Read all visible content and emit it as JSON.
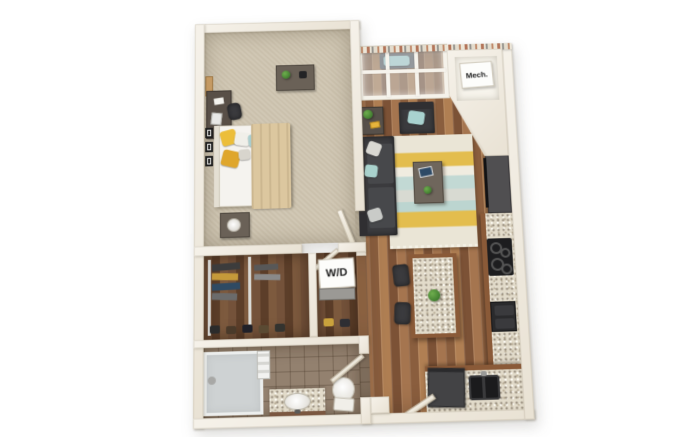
{
  "image": {
    "type": "3d-floor-plan",
    "description": "Top-down 3D dollhouse rendering of a one-bedroom, one-bathroom apartment floor plan on a white background"
  },
  "labels": {
    "mech": "Mech.",
    "wd": "W/D"
  },
  "palette": {
    "background": "#ffffff",
    "walls": "#f1ece3",
    "wall_shadow": "#d9d2c3",
    "bedroom_carpet": "#cfc5b1",
    "hardwood_floor": "#9c7049",
    "closet_wood": "#6b4a32",
    "bathroom_tile": "#93816f",
    "granite_counter": "#e2dbca",
    "cabinet_wood": "#8a5a38",
    "sofa_charcoal": "#3b3b3e",
    "accent_teal": "#accfcf",
    "accent_yellow": "#e6b93c",
    "rug_cream": "#eae5d6",
    "appliance_black": "#1d1d1f",
    "brick_trim": "#b3755a"
  },
  "regions": [
    {
      "id": "bedroom",
      "furniture": [
        "bed",
        "yellow-pillows",
        "teal-pillow",
        "throw-blanket",
        "nightstand",
        "table-lamp",
        "desk",
        "desk-chair",
        "laptop",
        "dresser",
        "potted-plant",
        "wall-art-frames",
        "pinboard",
        "door"
      ]
    },
    {
      "id": "living-room",
      "furniture": [
        "sectional-sofa",
        "throw-pillows",
        "armchair",
        "striped-area-rug",
        "coffee-table",
        "tablet",
        "small-plant",
        "side-table",
        "media-console"
      ]
    },
    {
      "id": "balcony-window-bay",
      "furniture": [
        "window-wall",
        "bench-seat",
        "teal-cushion"
      ]
    },
    {
      "id": "kitchen",
      "furniture": [
        "granite-island",
        "bar-stools",
        "cooktop",
        "drawer-appliance",
        "double-sink",
        "refrigerator",
        "l-shaped-counter"
      ]
    },
    {
      "id": "walk-in-closet",
      "furniture": [
        "hanging-clothes",
        "closet-rails",
        "shoe-row",
        "door"
      ]
    },
    {
      "id": "laundry-closet",
      "label_ref": "wd",
      "furniture": [
        "stacked-washer-dryer"
      ]
    },
    {
      "id": "bathroom",
      "furniture": [
        "walk-in-shower",
        "towel-shelf",
        "granite-vanity",
        "oval-sink",
        "toilet",
        "door"
      ]
    },
    {
      "id": "mechanical-closet",
      "label_ref": "mech",
      "furniture": [
        "water-heater"
      ]
    },
    {
      "id": "entry",
      "furniture": [
        "entry-door"
      ]
    }
  ]
}
